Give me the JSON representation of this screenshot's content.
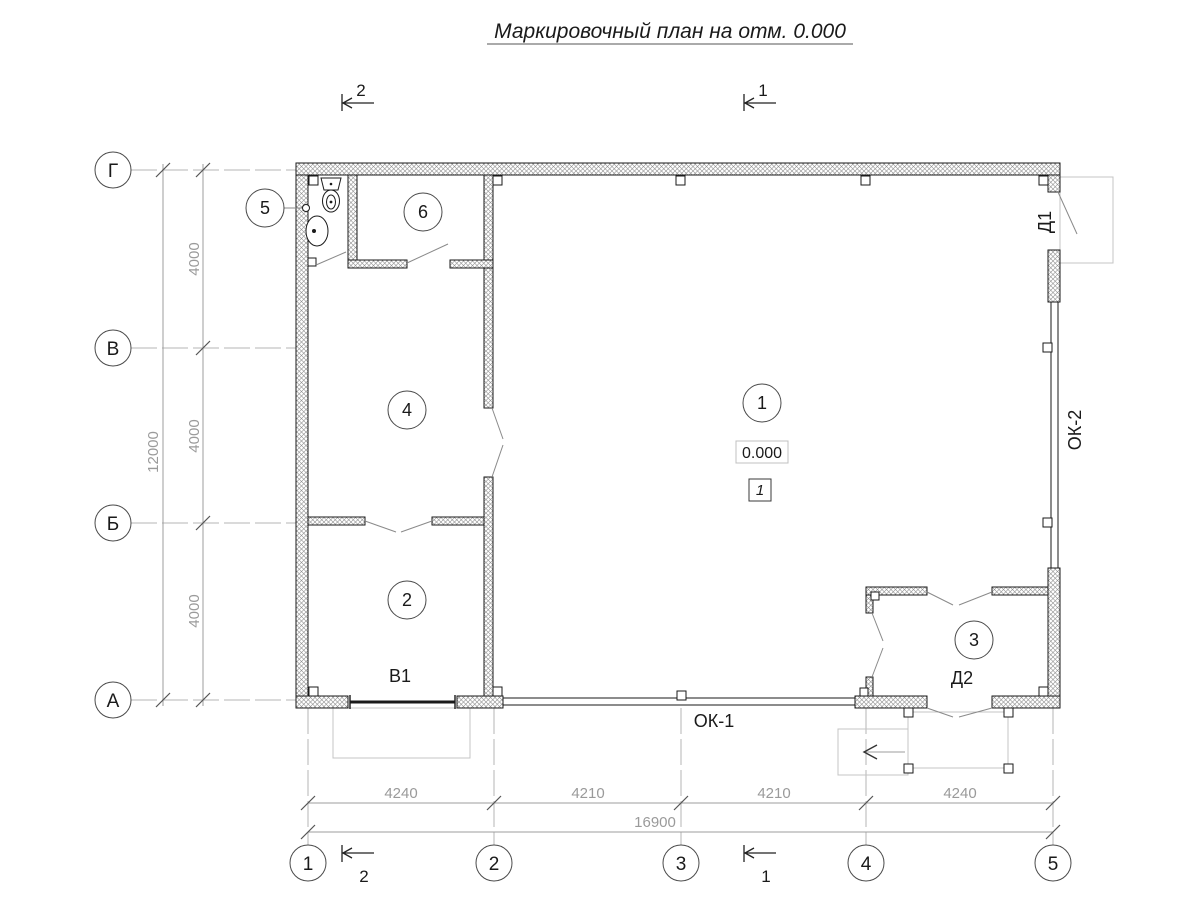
{
  "title": "Маркировочный план на отм. 0.000",
  "axes": {
    "vertical": [
      "Г",
      "В",
      "Б",
      "А"
    ],
    "horizontal": [
      "1",
      "2",
      "3",
      "4",
      "5"
    ]
  },
  "dimensions": {
    "left_segments": [
      "4000",
      "4000",
      "4000"
    ],
    "left_total": "12000",
    "bottom_segments": [
      "4240",
      "4210",
      "4210",
      "4240"
    ],
    "bottom_total": "16900"
  },
  "rooms": [
    "1",
    "2",
    "3",
    "4",
    "5",
    "6"
  ],
  "marks": {
    "door_d1": "Д1",
    "door_d2": "Д2",
    "gate_v1": "В1",
    "window_ok1": "ОК-1",
    "window_ok2": "ОК-2"
  },
  "elevation_mark": "0.000",
  "detail_ref": "1",
  "section_marks": {
    "one": "1",
    "two": "2"
  },
  "colors": {
    "line": "#1a1a1a",
    "dim": "#9a9a9a",
    "construction": "#c4c4c4"
  }
}
